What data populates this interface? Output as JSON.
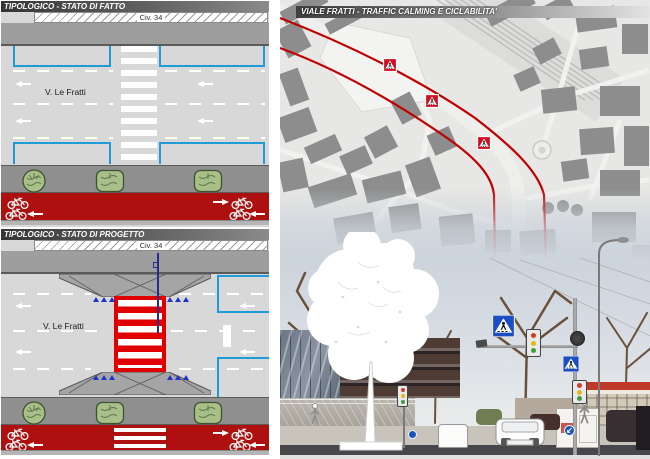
{
  "typological_existing": {
    "title": "TIPOLOGICO - STATO DI FATTO",
    "civic_number_label": "Civ. 34",
    "street_name": "V. Le Fratti"
  },
  "typological_project": {
    "title": "TIPOLOGICO - STATO DI PROGETTO",
    "civic_number_label": "Civ. 34",
    "street_name": "V. Le Fratti"
  },
  "map_panel": {
    "title": "VIALE FRATTI - TRAFFIC CALMING E CICLABILITA'",
    "marker_count": 3
  },
  "colors": {
    "bike_lane_red": "#ae0f0f",
    "route_red": "#c00000",
    "parking_bay_blue": "#1f9cd8",
    "raised_crossing_red": "#e10000",
    "map_building_gray": "#8d8d8d",
    "sign_blue": "#1a4fc4"
  },
  "icons": [
    "bicycle-icon",
    "tree-icon",
    "road-arrow-icon",
    "raised-crossing-marker-icon",
    "pedestrian-crossing-sign-icon",
    "traffic-light-icon",
    "round-arrow-sign-icon"
  ]
}
